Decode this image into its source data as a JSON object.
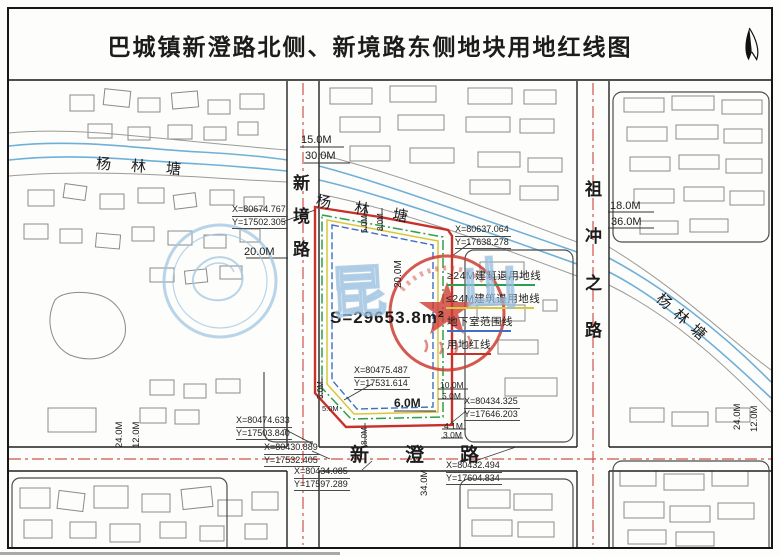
{
  "title": "巴城镇新澄路北侧、新境路东侧地块用地红线图",
  "plot": {
    "area_label": "S=29653.8m²"
  },
  "roads": {
    "xinjing": "新境路",
    "xincheng": "新澄路",
    "zuchongzhi": "祖冲之路"
  },
  "waterway": {
    "name": "杨林塘"
  },
  "legend": {
    "items": [
      {
        "label": "≥24M建筑退用地线",
        "color": "#2f9e4f"
      },
      {
        "label": "≤24M建筑退用地线",
        "color": "#d9c63e"
      },
      {
        "label": "地下室范围线",
        "color": "#3f6fc4"
      },
      {
        "label": "用地红线",
        "color": "#c8302a"
      }
    ]
  },
  "coordinates": [
    {
      "x": "X=80674.767",
      "y": "Y=17502.305"
    },
    {
      "x": "X=80637.064",
      "y": "Y=17638.278"
    },
    {
      "x": "X=80475.487",
      "y": "Y=17531.614"
    },
    {
      "x": "X=80434.325",
      "y": "Y=17646.203"
    },
    {
      "x": "X=80474.633",
      "y": "Y=17503.840"
    },
    {
      "x": "X=80430.889",
      "y": "Y=17532.405"
    },
    {
      "x": "X=80434.085",
      "y": "Y=17597.289"
    },
    {
      "x": "X=80432.494",
      "y": "Y=17604.834"
    }
  ],
  "dimensions": [
    "15.0M",
    "30.0M",
    "20.0M",
    "20.0M",
    "5.0M",
    "8.0M",
    "5.0M",
    "5.0M",
    "8.0M",
    "6.0M",
    "10.0M",
    "5.0M",
    "4.1M",
    "3.0M",
    "34.0M",
    "18.0M",
    "36.0M",
    "24.0M",
    "12.0M",
    "24.0M",
    "12.0M"
  ],
  "watermark": {
    "char1": "昆",
    "char2": "山"
  },
  "colors": {
    "red_line": "#c8302a",
    "green_setback": "#2f9e4f",
    "yellow_setback": "#d9c63e",
    "blue_basement": "#3f6fc4",
    "water_blue": "#6fb0d8",
    "centerline_red": "#d0534b",
    "stamp_red": "#cd3c32",
    "watermark_blue": "#a9c7e2"
  }
}
